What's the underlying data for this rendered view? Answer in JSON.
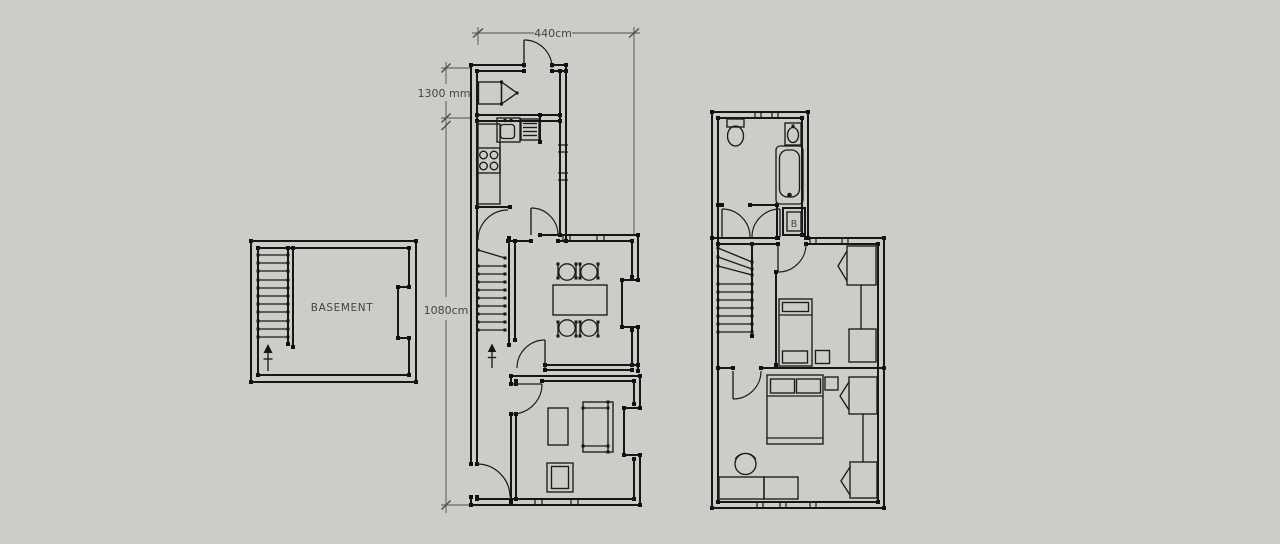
{
  "canvas": {
    "background_color": "#cccdc8",
    "wall_color": "#161616",
    "dimension_color": "#4e4e49",
    "text_color": "#45453e"
  },
  "dimensions": {
    "top_width": "440cm",
    "porch_depth": "1300 mm",
    "side_height": "1080cm"
  },
  "labels": {
    "basement": "BASEMENT",
    "boiler": "B"
  }
}
